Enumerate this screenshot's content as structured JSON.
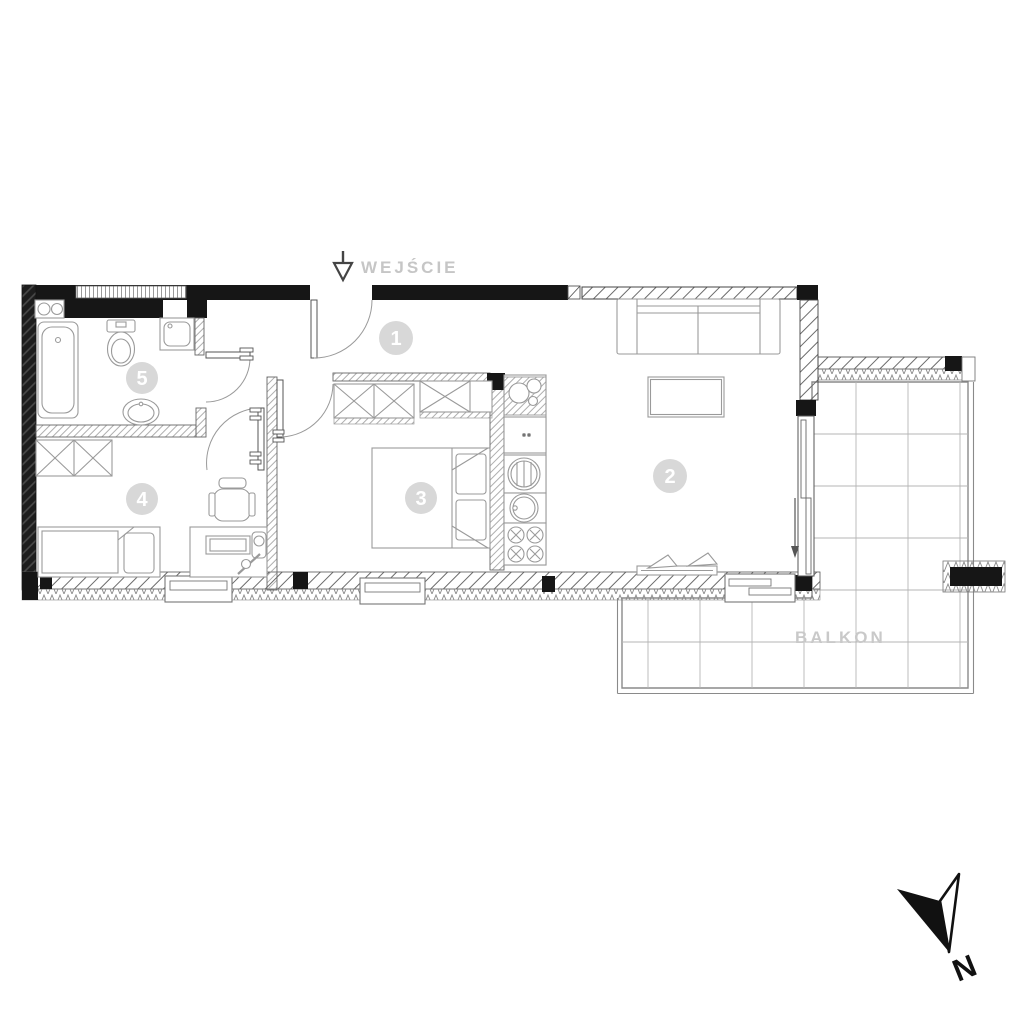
{
  "labels": {
    "entrance": "WEJŚCIE",
    "balcony": "BALKON",
    "north": "N"
  },
  "rooms": [
    {
      "number": "1"
    },
    {
      "number": "2"
    },
    {
      "number": "3"
    },
    {
      "number": "4"
    },
    {
      "number": "5"
    }
  ],
  "colors": {
    "wall_black": "#161616",
    "line_gray": "#8f8f8f",
    "label_gray": "#c6c6c6",
    "badge_gray": "#d8d8d8"
  }
}
